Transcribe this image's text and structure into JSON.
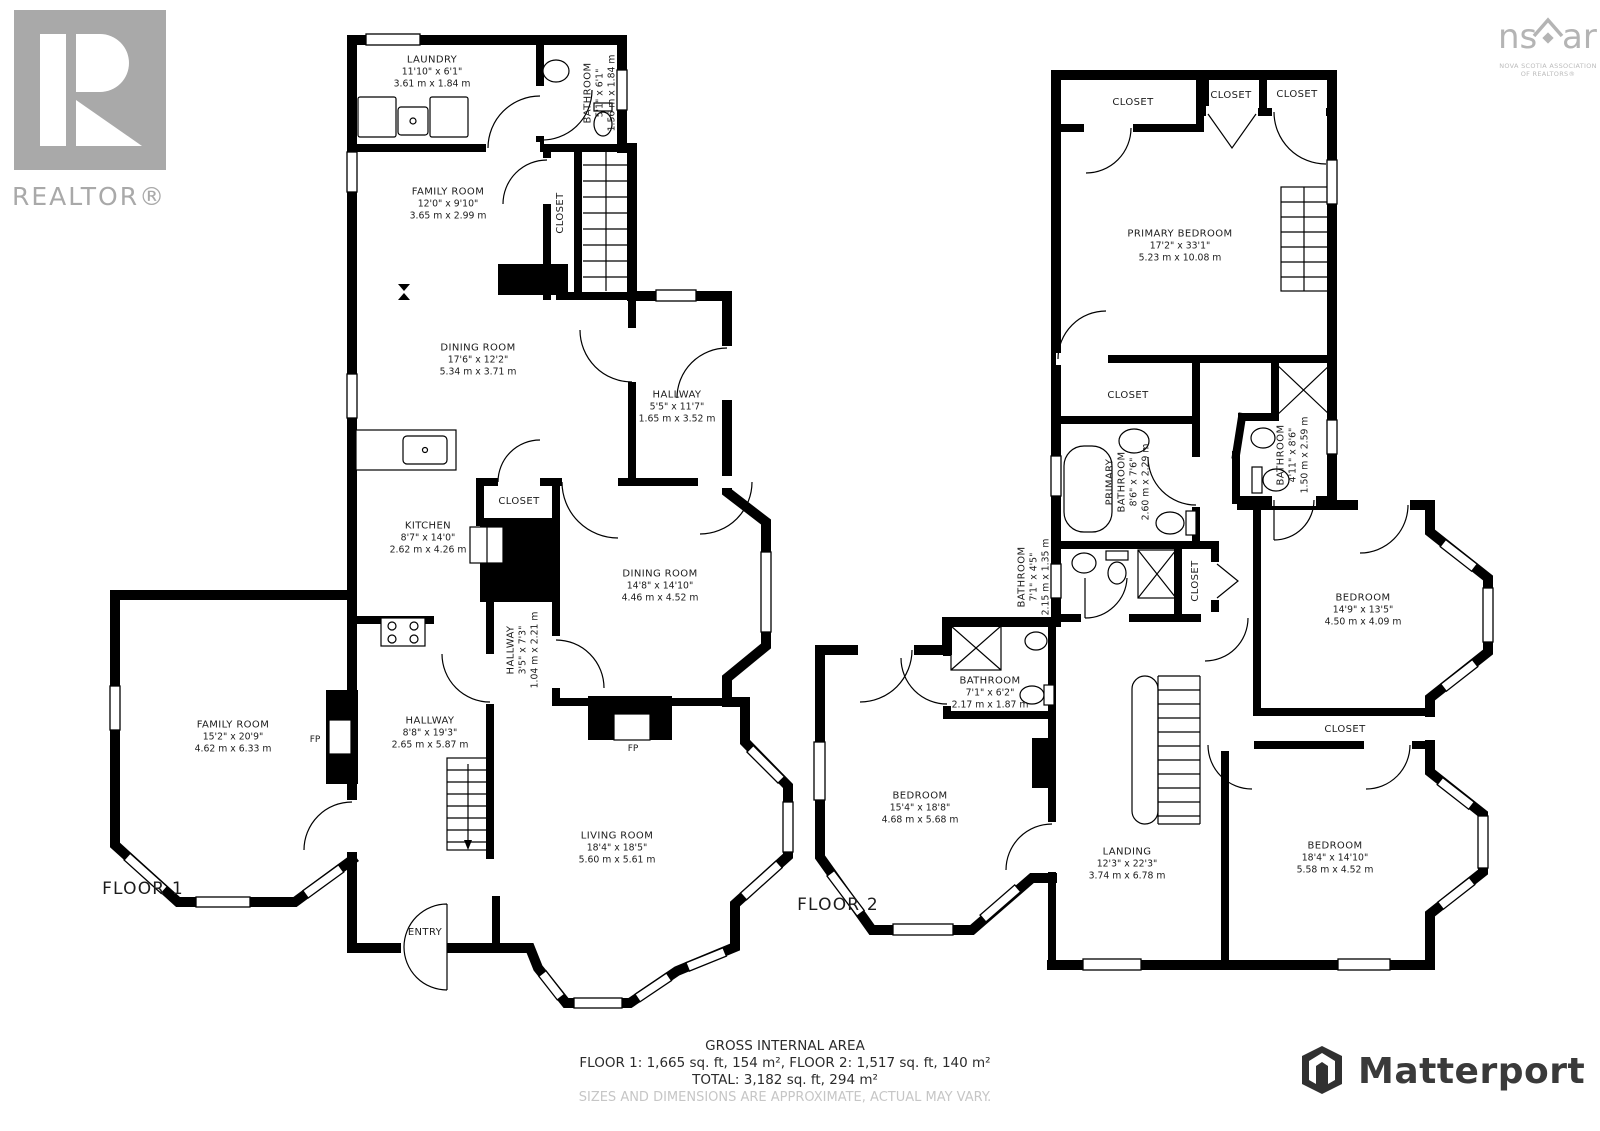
{
  "branding": {
    "realtor": {
      "logo_text": "REALTOR®"
    },
    "nsar": {
      "ns": "ns",
      "ar": "ar",
      "caption_line1": "NOVA SCOTIA ASSOCIATION",
      "caption_line2": "OF REALTORS®"
    },
    "matterport": {
      "label": "Matterport"
    }
  },
  "floor1": {
    "label": "FLOOR 1",
    "rooms": {
      "laundry": {
        "name": "LAUNDRY",
        "imperial": "11'10\" x 6'1\"",
        "metric": "3.61 m x 1.84 m"
      },
      "bathroom": {
        "name": "BATHROOM",
        "imperial": "5'1\" x 6'1\"",
        "metric": "1.56 m x 1.84 m"
      },
      "family_room_small": {
        "name": "FAMILY ROOM",
        "imperial": "12'0\" x 9'10\"",
        "metric": "3.65 m x 2.99 m"
      },
      "closet_stairs": {
        "name": "CLOSET"
      },
      "dining_room_1": {
        "name": "DINING ROOM",
        "imperial": "17'6\" x 12'2\"",
        "metric": "5.34 m x 3.71 m"
      },
      "hallway_upper": {
        "name": "HALLWAY",
        "imperial": "5'5\" x 11'7\"",
        "metric": "1.65 m x 3.52 m"
      },
      "kitchen": {
        "name": "KITCHEN",
        "imperial": "8'7\" x 14'0\"",
        "metric": "2.62 m x 4.26 m"
      },
      "closet_kitchen": {
        "name": "CLOSET"
      },
      "dining_room_2": {
        "name": "DINING ROOM",
        "imperial": "14'8\" x 14'10\"",
        "metric": "4.46 m x 4.52 m"
      },
      "hallway_small": {
        "name": "HALLWAY",
        "imperial": "3'5\" x 7'3\"",
        "metric": "1.04 m x 2.21 m"
      },
      "family_room_large": {
        "name": "FAMILY ROOM",
        "imperial": "15'2\" x 20'9\"",
        "metric": "4.62 m x 6.33 m"
      },
      "hallway_main": {
        "name": "HALLWAY",
        "imperial": "8'8\" x 19'3\"",
        "metric": "2.65 m x 5.87 m"
      },
      "living_room": {
        "name": "LIVING ROOM",
        "imperial": "18'4\" x 18'5\"",
        "metric": "5.60 m x 5.61 m"
      },
      "entry": {
        "name": "ENTRY"
      },
      "fireplace_family": {
        "name": "FP"
      },
      "fireplace_living": {
        "name": "FP"
      }
    }
  },
  "floor2": {
    "label": "FLOOR 2",
    "rooms": {
      "closet_top_1": {
        "name": "CLOSET"
      },
      "closet_top_2": {
        "name": "CLOSET"
      },
      "closet_top_3": {
        "name": "CLOSET"
      },
      "primary_bedroom": {
        "name": "PRIMARY BEDROOM",
        "imperial": "17'2\" x 33'1\"",
        "metric": "5.23 m x 10.08 m"
      },
      "closet_mid": {
        "name": "CLOSET"
      },
      "primary_bathroom": {
        "name_line1": "PRIMARY",
        "name_line2": "BATHROOM",
        "imperial": "8'6\" x 7'6\"",
        "metric": "2.60 m x 2.29 m"
      },
      "bathroom_ensuite": {
        "name": "BATHROOM",
        "imperial": "4'11\" x 8'6\"",
        "metric": "1.50 m x 2.59 m"
      },
      "bathroom_small": {
        "name": "BATHROOM",
        "imperial": "7'1\" x 4'5\"",
        "metric": "2.15 m x 1.35 m"
      },
      "closet_hall": {
        "name": "CLOSET"
      },
      "bedroom_right": {
        "name": "BEDROOM",
        "imperial": "14'9\" x 13'5\"",
        "metric": "4.50 m x 4.09 m"
      },
      "closet_bedroom": {
        "name": "CLOSET"
      },
      "bathroom_center": {
        "name": "BATHROOM",
        "imperial": "7'1\" x 6'2\"",
        "metric": "2.17 m x 1.87 m"
      },
      "bedroom_left": {
        "name": "BEDROOM",
        "imperial": "15'4\" x 18'8\"",
        "metric": "4.68 m x 5.68 m"
      },
      "landing": {
        "name": "LANDING",
        "imperial": "12'3\" x 22'3\"",
        "metric": "3.74 m x 6.78 m"
      },
      "bedroom_bottom": {
        "name": "BEDROOM",
        "imperial": "18'4\" x 14'10\"",
        "metric": "5.58 m x 4.52 m"
      }
    }
  },
  "footer": {
    "title": "GROSS INTERNAL AREA",
    "line1": "FLOOR 1: 1,665 sq. ft, 154 m², FLOOR 2: 1,517 sq. ft, 140 m²",
    "line2": "TOTAL: 3,182 sq. ft, 294 m²",
    "disclaimer": "SIZES AND DIMENSIONS ARE APPROXIMATE, ACTUAL MAY VARY."
  },
  "colors": {
    "wall": "#000000",
    "logo_gray": "#a9a9a9",
    "matterport_dark": "#3a3a3a",
    "disclaimer_gray": "#c6c6c6"
  }
}
